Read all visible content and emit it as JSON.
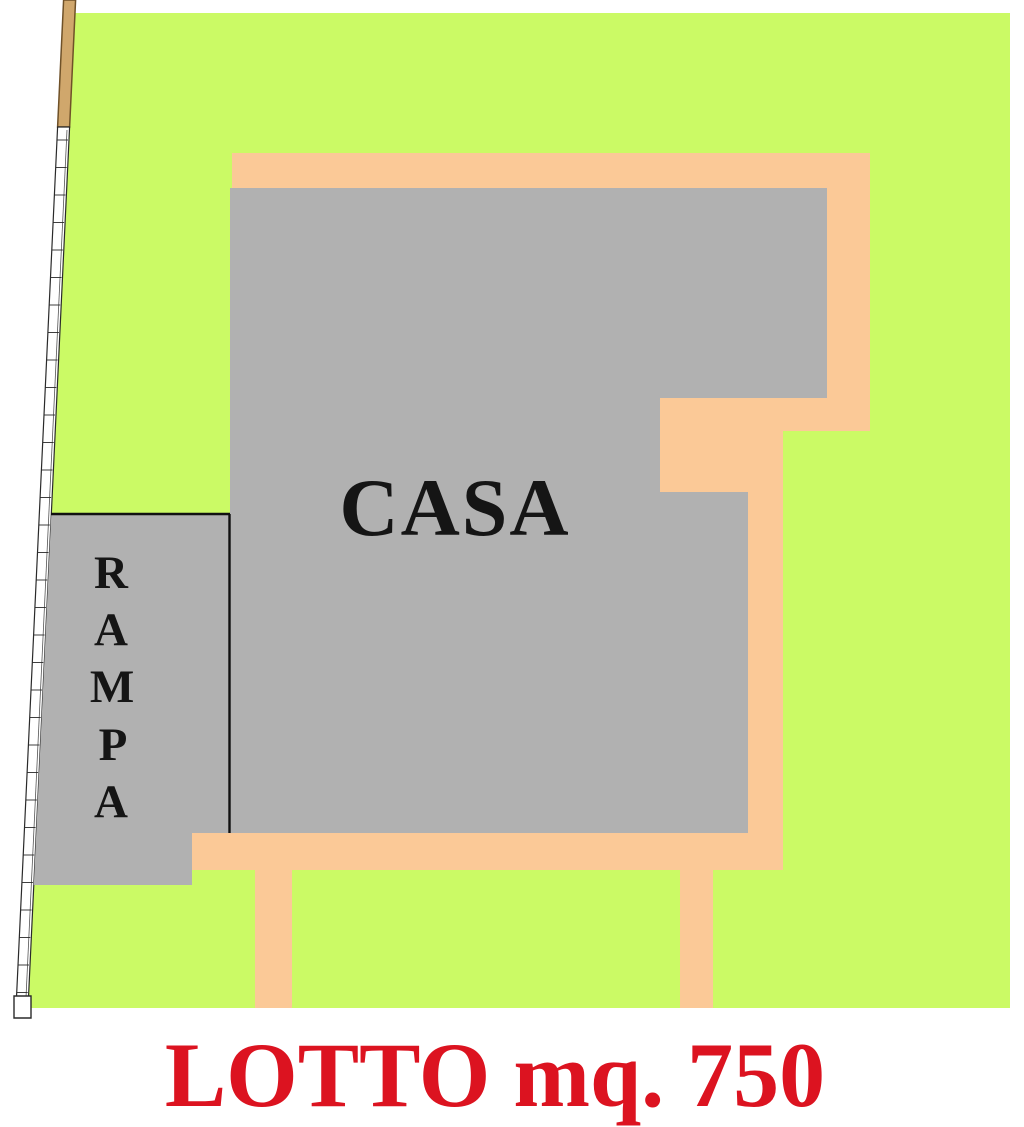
{
  "plan": {
    "type": "site-plan",
    "labels": {
      "house": "CASA",
      "ramp": "RAMPA",
      "ramp_letters": [
        "R",
        "A",
        "M",
        "P",
        "A"
      ],
      "lot_caption": "LOTTO mq. 750"
    },
    "lot": {
      "area_mq": "750"
    },
    "colors": {
      "lot_green": "#CBFA65",
      "path_orange": "#FBC997",
      "building_gray": "#B1B1B1",
      "road_tan": "#D0A76C",
      "road_tan_border": "#6F5128",
      "caption_red": "#DC1320",
      "text_black": "#151515",
      "line_black": "#111111"
    }
  }
}
